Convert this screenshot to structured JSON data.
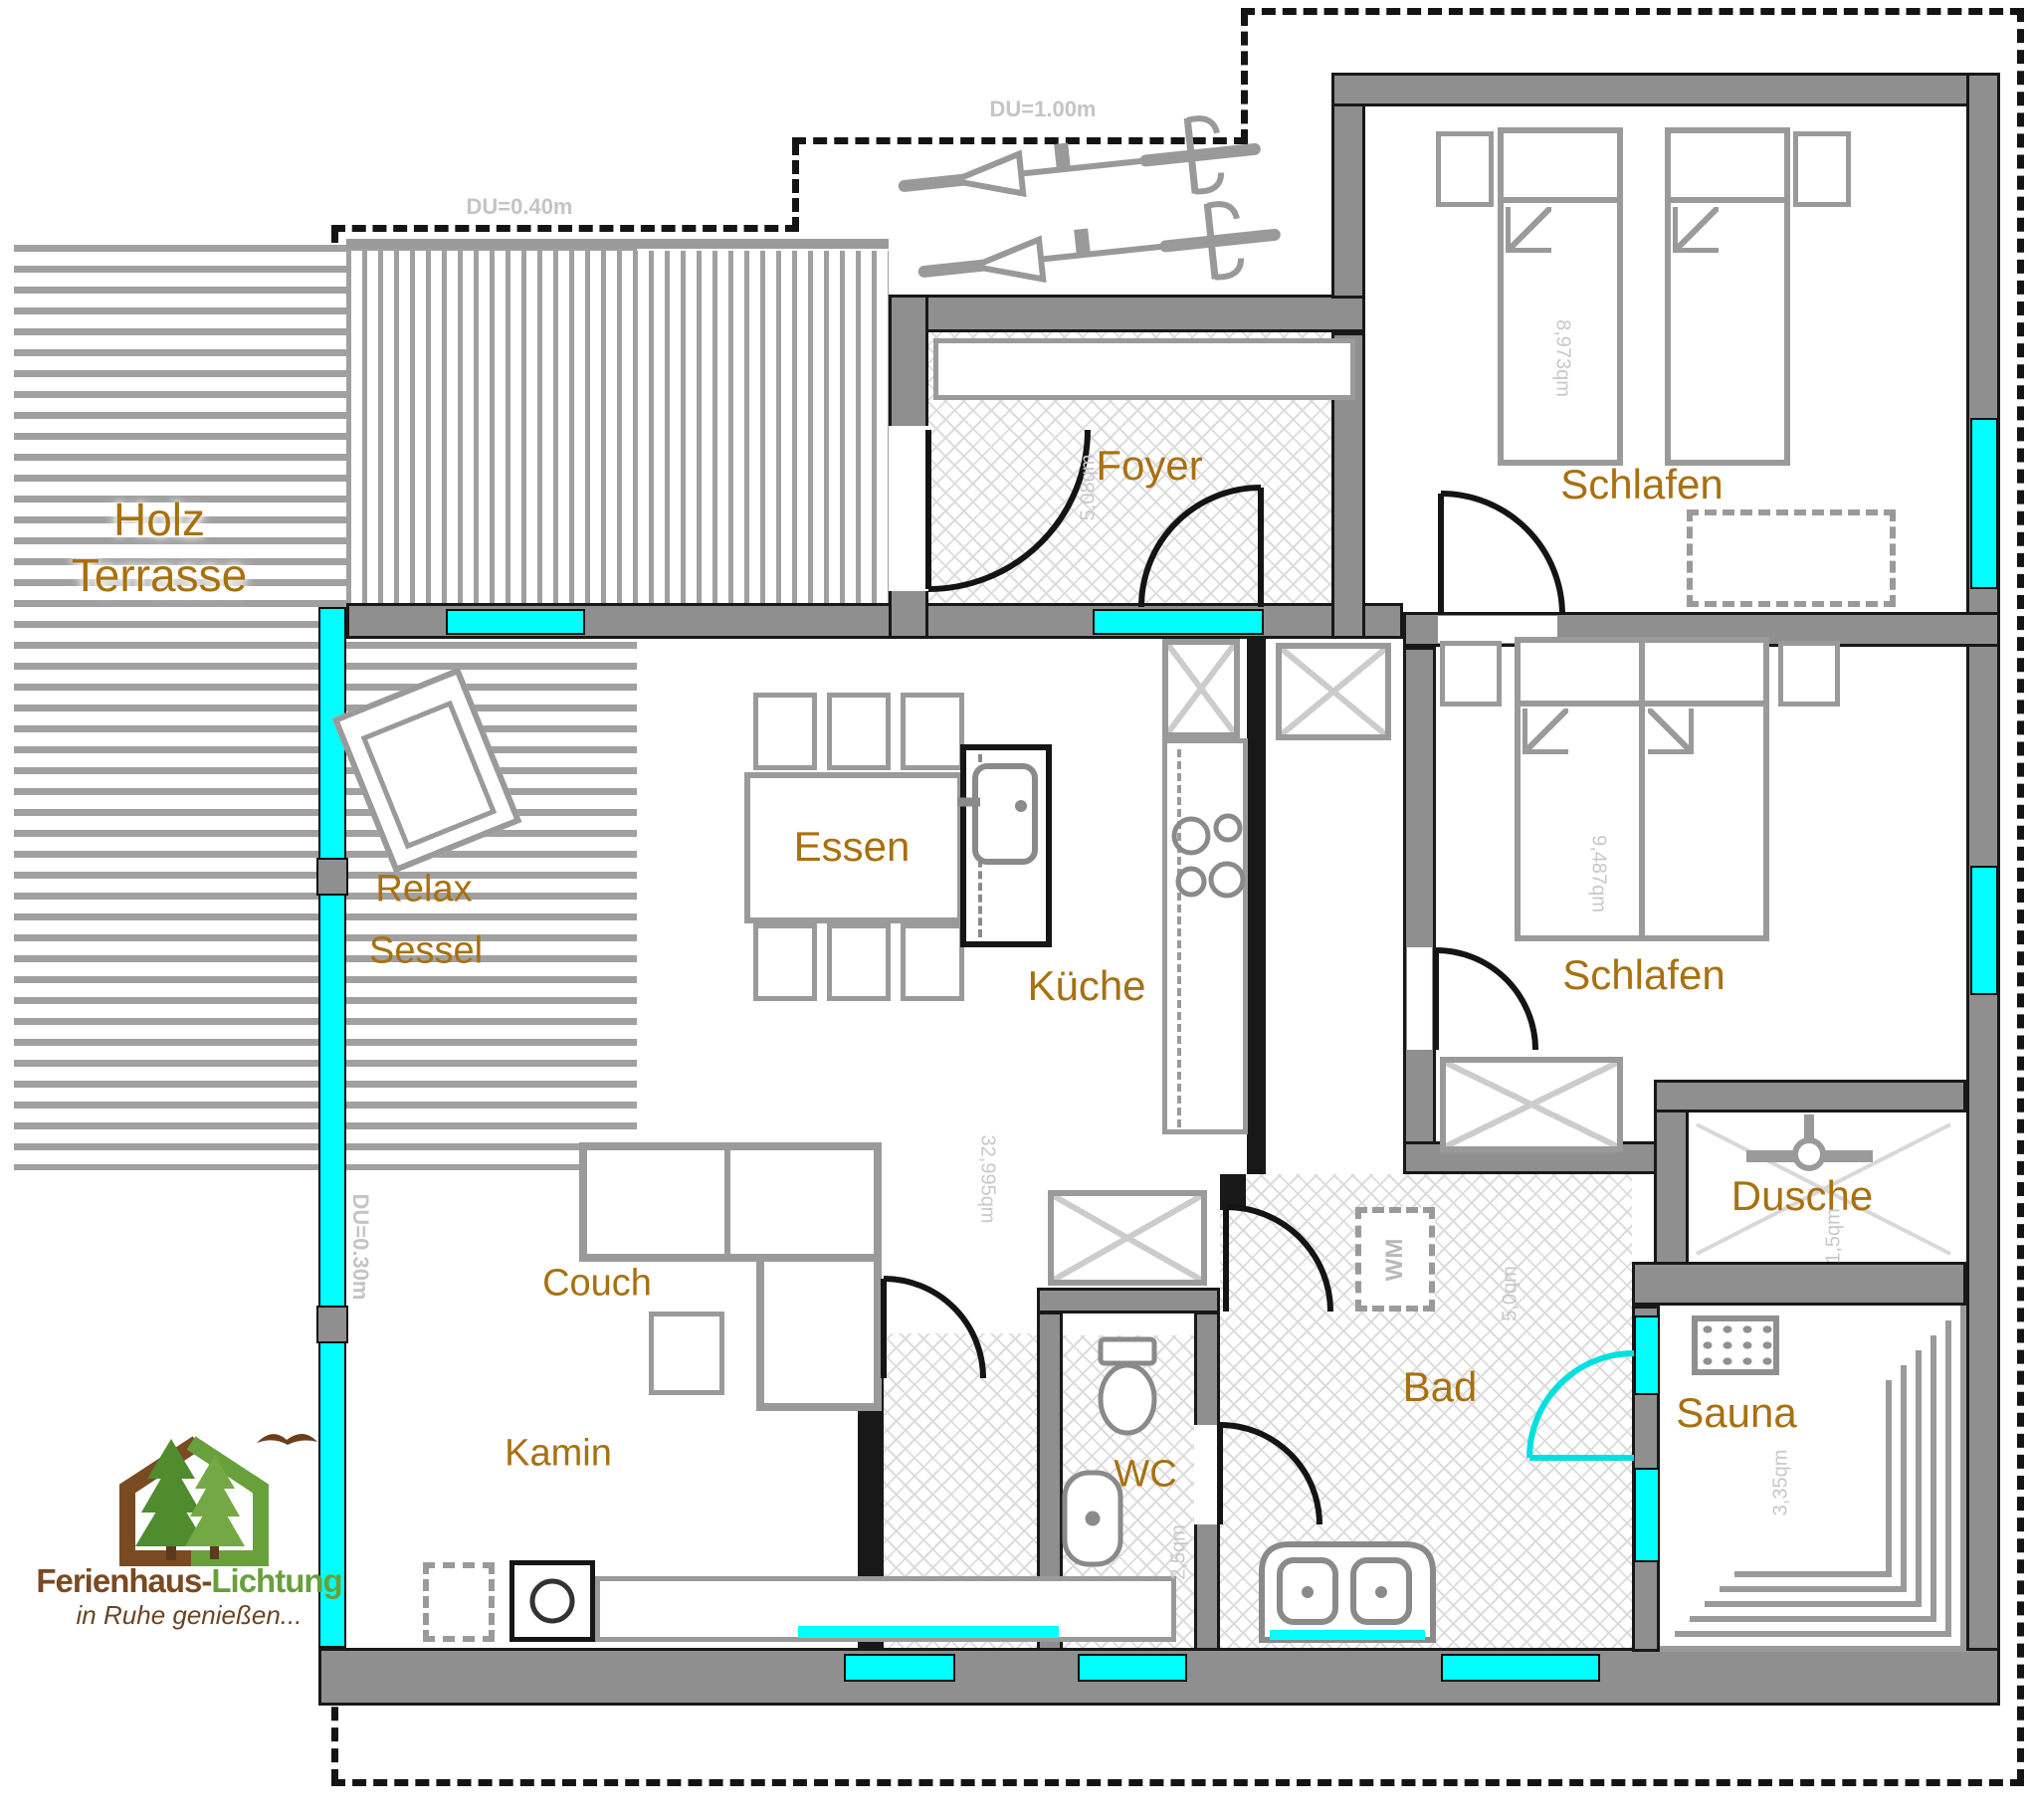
{
  "logo": {
    "brand_brown": "Ferienhaus-",
    "brand_green": "Lichtung",
    "tagline": "in Ruhe genießen..."
  },
  "overhang": {
    "left": "DU=0.30m",
    "top_left": "DU=0.40m",
    "top_right": "DU=1.00m"
  },
  "terrace": {
    "line1": "Holz",
    "line2": "Terrasse"
  },
  "rooms": {
    "foyer": {
      "name": "Foyer",
      "area": "5,08qm"
    },
    "bedroom1": {
      "name": "Schlafen",
      "area": "8,973qm"
    },
    "bedroom2": {
      "name": "Schlafen",
      "area": "9,487qm"
    },
    "living": {
      "area": "32,995qm"
    },
    "kitchen": {
      "name": "Küche"
    },
    "wc": {
      "name": "WC",
      "area": "2,5qm"
    },
    "bath": {
      "name": "Bad",
      "area": "5,0qm"
    },
    "shower": {
      "name": "Dusche",
      "area": "1,5qm"
    },
    "sauna": {
      "name": "Sauna",
      "area": "3,35qm"
    }
  },
  "furniture": {
    "relax1": "Relax",
    "relax2": "Sessel",
    "dining": "Essen",
    "couch": "Couch",
    "fireplace": "Kamin",
    "washer": "WM"
  },
  "colors": {
    "room_label": "#a8700f",
    "area_label": "#c8c8c8",
    "window": "#00ffff",
    "wall": "#8f8f8f",
    "logo_brown": "#7a4a22",
    "logo_green": "#68a03c"
  }
}
